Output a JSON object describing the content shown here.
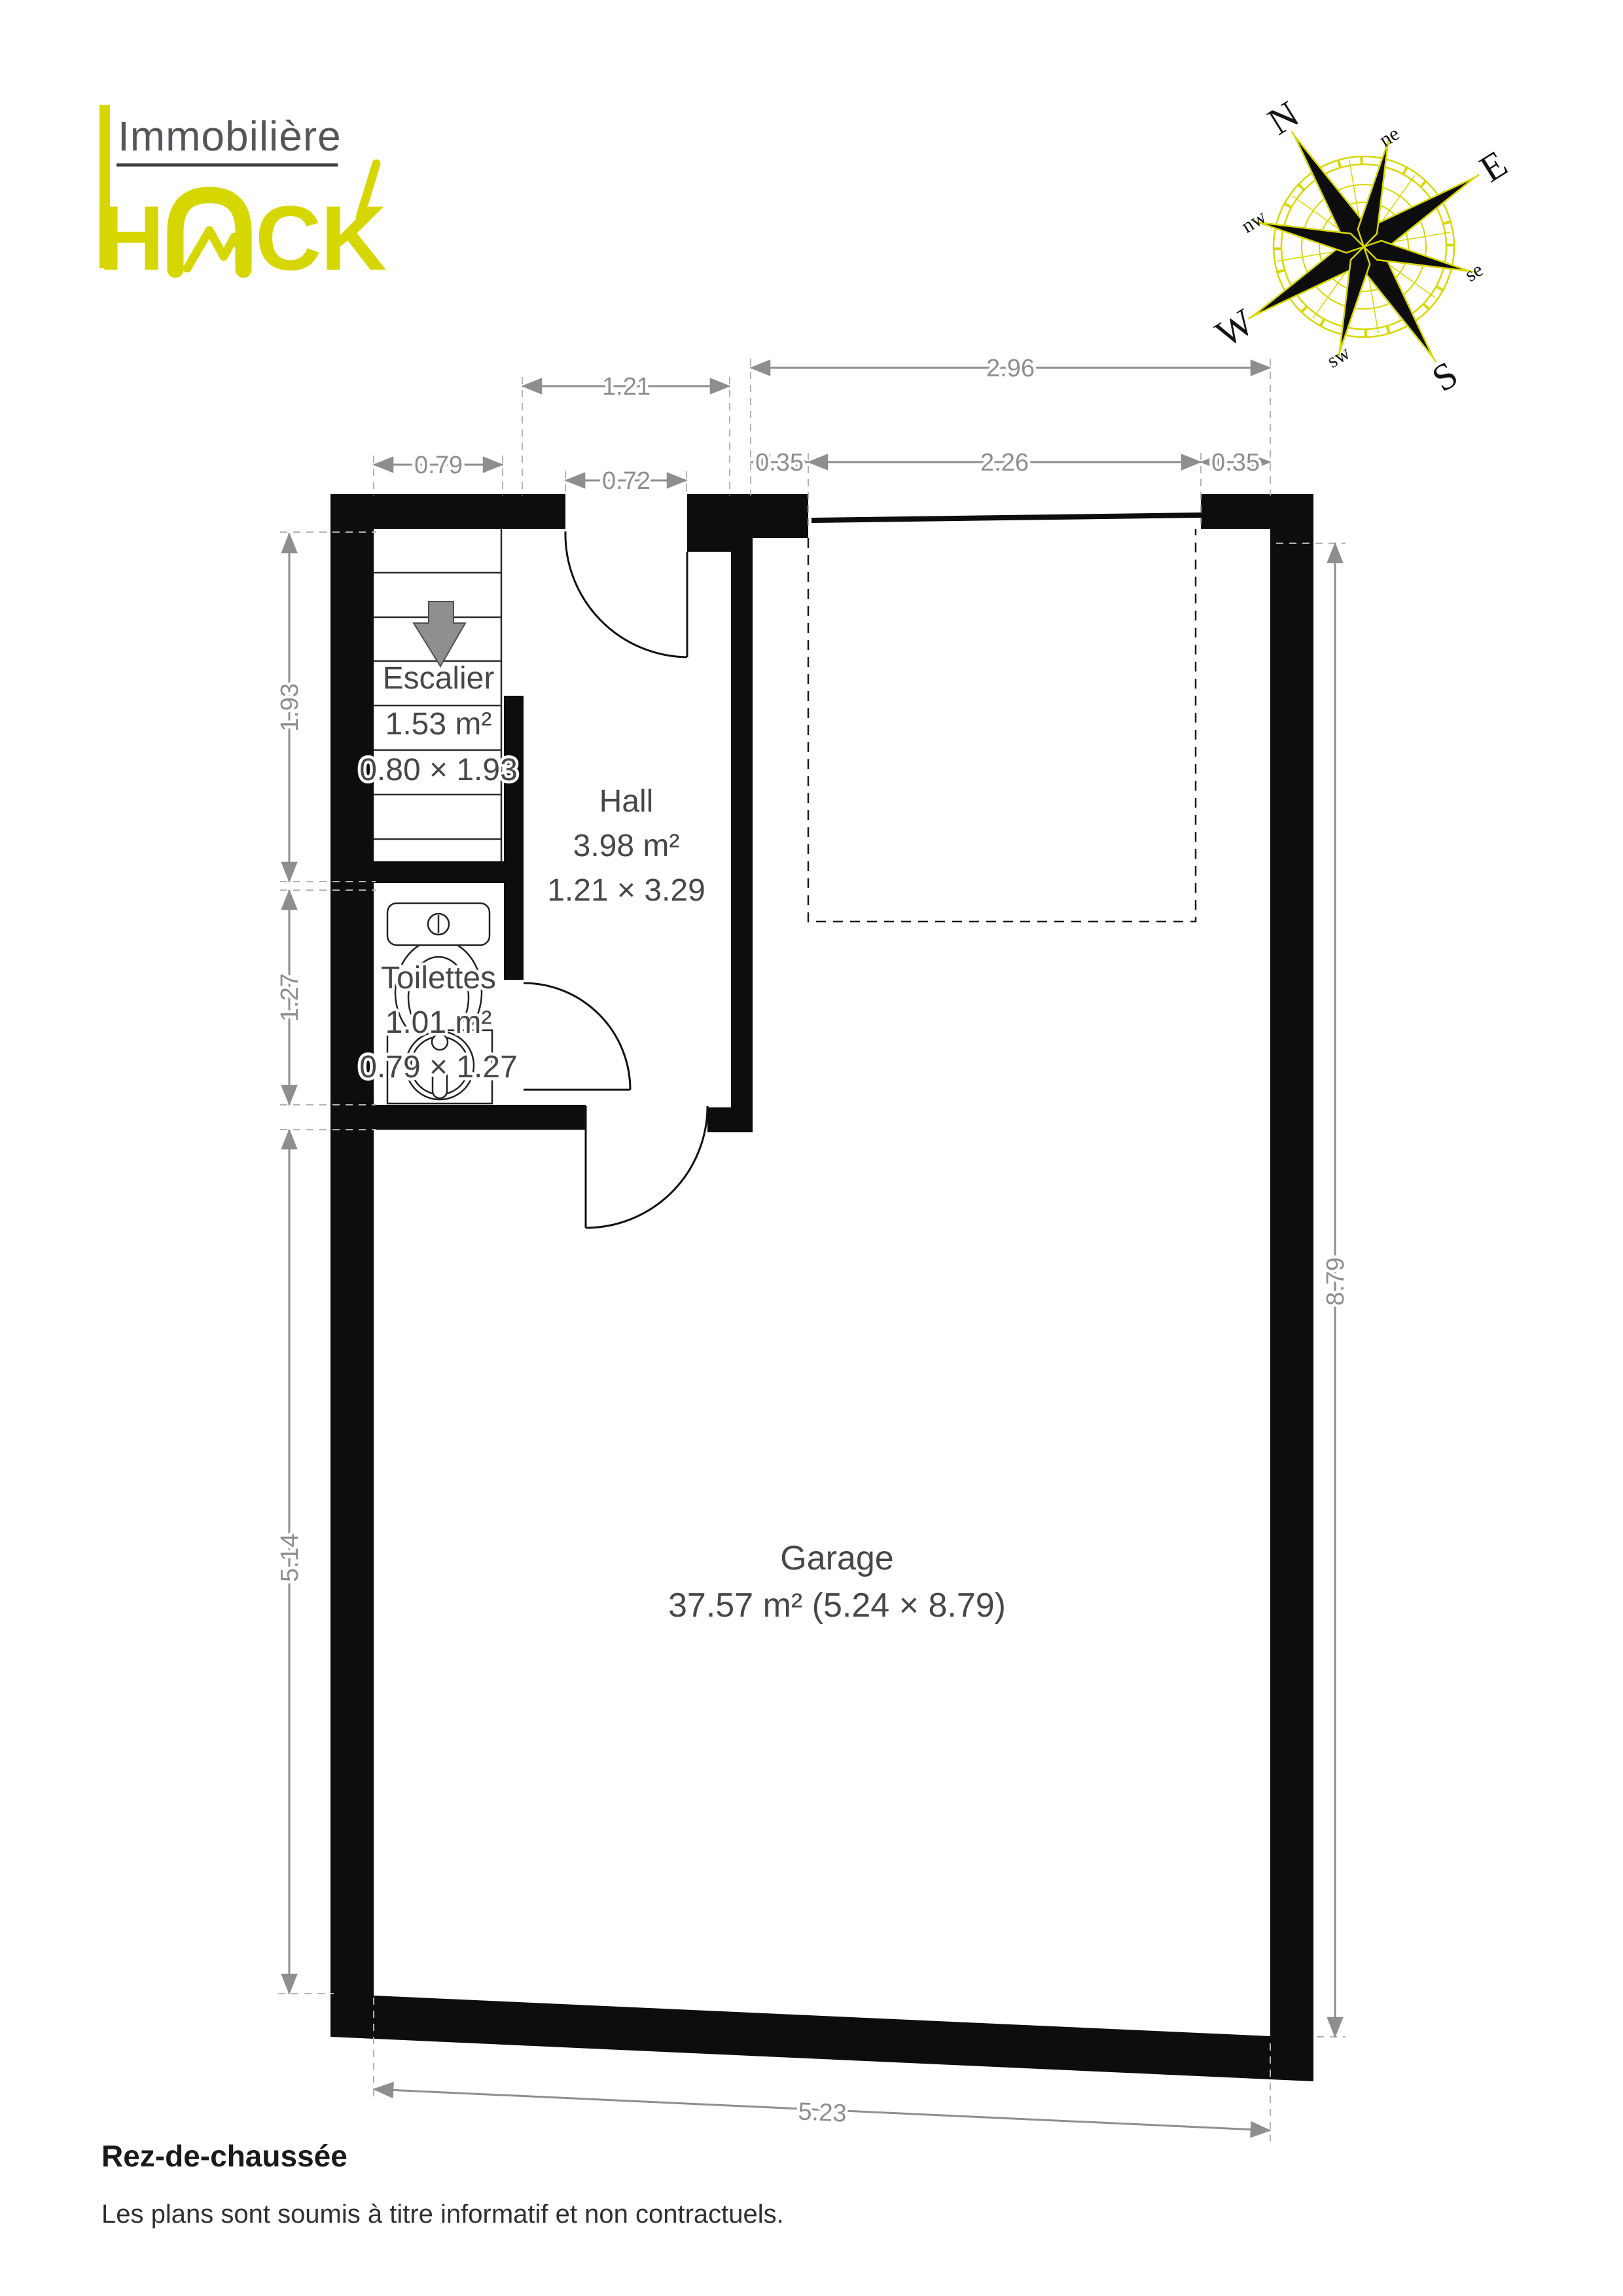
{
  "logo": {
    "line1": "Immobilière",
    "line2_h": "H",
    "line2_c": "C",
    "line2_k": "K",
    "word": "HACK"
  },
  "compass": {
    "n": "N",
    "e": "E",
    "s": "S",
    "w": "W",
    "ne": "ne",
    "se": "se",
    "sw": "sw",
    "nw": "nw"
  },
  "rooms": {
    "escalier": {
      "name": "Escalier",
      "area": "1.53 m²",
      "size": "0.80 × 1.93"
    },
    "hall": {
      "name": "Hall",
      "area": "3.98 m²",
      "size": "1.21 × 3.29"
    },
    "toilettes": {
      "name": "Toilettes",
      "area": "1.01 m²",
      "size": "0.79 × 1.27"
    },
    "garage": {
      "name": "Garage",
      "area": "37.57 m² (5.24 × 8.79)"
    }
  },
  "dims": {
    "top_wall": "2.96",
    "hall_width": "1.21",
    "stair_width": "0.79",
    "entry_door": "0.72",
    "pier_left": "0.35",
    "garage_door": "2.26",
    "pier_right": "0.35",
    "stair_length": "1.93",
    "wc_length": "1.27",
    "left_lower": "5.14",
    "right_height": "8.79",
    "bottom_width": "5.23"
  },
  "footer": {
    "title": "Rez-de-chaussée",
    "note": "Les plans sont soumis à titre informatif et non contractuels."
  },
  "colors": {
    "accent": "#d6d600",
    "wall": "#0d0d0d",
    "dim_gray": "#8e8e8e",
    "label_gray": "#474747"
  }
}
